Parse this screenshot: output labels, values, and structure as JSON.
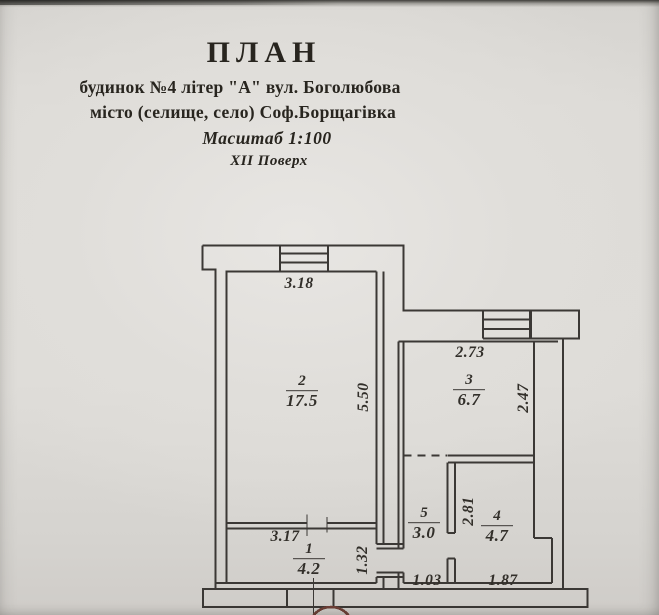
{
  "header": {
    "title": "ПЛАН",
    "building": "будинок №4 літер \"А\"  вул. Боголюбова",
    "city": "місто (селище, село) Соф.Борщагівка",
    "scale": "Масштаб 1:100",
    "floor": "XII Поверх"
  },
  "plan": {
    "rooms": {
      "r1": {
        "number": "1",
        "area": "4.2"
      },
      "r2": {
        "number": "2",
        "area": "17.5"
      },
      "r3": {
        "number": "3",
        "area": "6.7"
      },
      "r4": {
        "number": "4",
        "area": "4.7"
      },
      "r5": {
        "number": "5",
        "area": "3.0"
      }
    },
    "dimensions": {
      "room2_width": "3.18",
      "room2_depth": "5.50",
      "room3_width": "2.73",
      "room3_depth": "2.47",
      "room1_width": "3.17",
      "room1_depth": "1.32",
      "room5_width": "1.03",
      "room4_depth": "2.81",
      "room4_width": "1.87"
    }
  },
  "colors": {
    "ink": "#3b3835",
    "paper": "#dcdad6",
    "stamp": "#6e4037"
  }
}
